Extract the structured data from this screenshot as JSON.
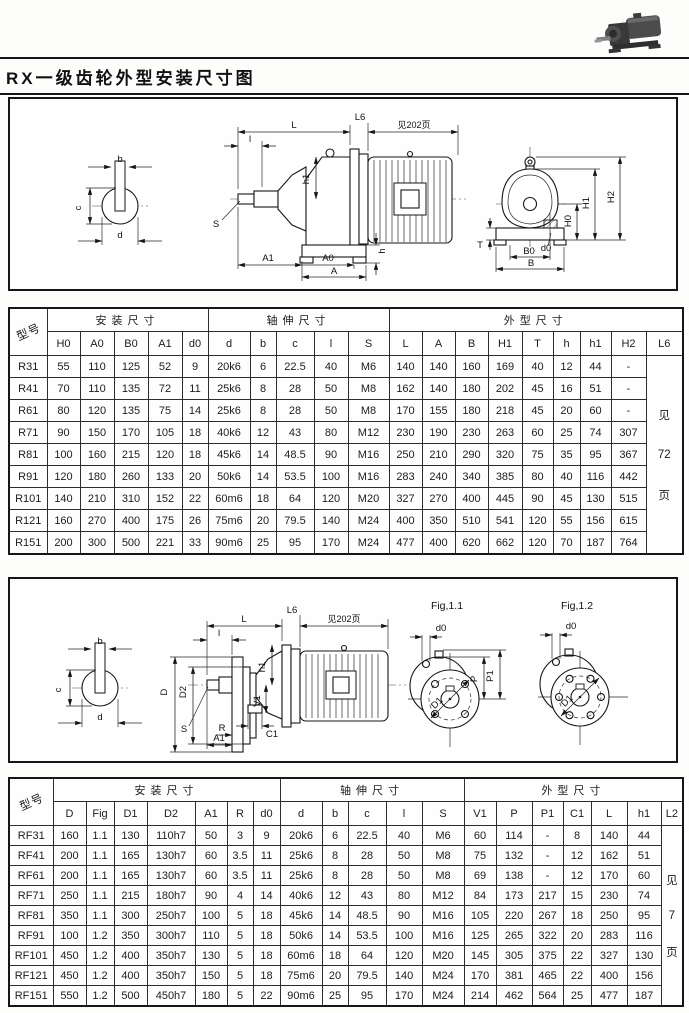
{
  "page": {
    "title": "RX一级齿轮外型安装尺寸图"
  },
  "diagram1": {
    "section": {
      "b": "b",
      "c": "c",
      "d": "d"
    },
    "side": {
      "L": "L",
      "L6": "L6",
      "see_note": "见202页",
      "l": "l",
      "h1": "h1",
      "h": "h",
      "A1": "A1",
      "A0": "A0",
      "A": "A",
      "S": "S"
    },
    "front": {
      "H0": "H0",
      "H1": "H1",
      "H2": "H2",
      "d0": "d0",
      "T": "T",
      "B0": "B0",
      "B": "B"
    }
  },
  "table1": {
    "model_header": "型号",
    "groups": {
      "install": "安装尺寸",
      "shaft": "轴伸尺寸",
      "outline": "外型尺寸"
    },
    "columns": [
      "H0",
      "A0",
      "B0",
      "A1",
      "d0",
      "d",
      "b",
      "c",
      "l",
      "S",
      "L",
      "A",
      "B",
      "H1",
      "T",
      "h",
      "h1",
      "H2",
      "L6"
    ],
    "note_lines": [
      "见",
      "72",
      "页"
    ],
    "rows": [
      {
        "model": "R31",
        "values": [
          "55",
          "110",
          "125",
          "52",
          "9",
          "20k6",
          "6",
          "22.5",
          "40",
          "M6",
          "140",
          "140",
          "160",
          "169",
          "40",
          "12",
          "44",
          "-"
        ]
      },
      {
        "model": "R41",
        "values": [
          "70",
          "110",
          "135",
          "72",
          "11",
          "25k6",
          "8",
          "28",
          "50",
          "M8",
          "162",
          "140",
          "180",
          "202",
          "45",
          "16",
          "51",
          "-"
        ]
      },
      {
        "model": "R61",
        "values": [
          "80",
          "120",
          "135",
          "75",
          "14",
          "25k6",
          "8",
          "28",
          "50",
          "M8",
          "170",
          "155",
          "180",
          "218",
          "45",
          "20",
          "60",
          "-"
        ]
      },
      {
        "model": "R71",
        "values": [
          "90",
          "150",
          "170",
          "105",
          "18",
          "40k6",
          "12",
          "43",
          "80",
          "M12",
          "230",
          "190",
          "230",
          "263",
          "60",
          "25",
          "74",
          "307"
        ]
      },
      {
        "model": "R81",
        "values": [
          "100",
          "160",
          "215",
          "120",
          "18",
          "45k6",
          "14",
          "48.5",
          "90",
          "M16",
          "250",
          "210",
          "290",
          "320",
          "75",
          "35",
          "95",
          "367"
        ]
      },
      {
        "model": "R91",
        "values": [
          "120",
          "180",
          "260",
          "133",
          "20",
          "50k6",
          "14",
          "53.5",
          "100",
          "M16",
          "283",
          "240",
          "340",
          "385",
          "80",
          "40",
          "116",
          "442"
        ]
      },
      {
        "model": "R101",
        "values": [
          "140",
          "210",
          "310",
          "152",
          "22",
          "60m6",
          "18",
          "64",
          "120",
          "M20",
          "327",
          "270",
          "400",
          "445",
          "90",
          "45",
          "130",
          "515"
        ]
      },
      {
        "model": "R121",
        "values": [
          "160",
          "270",
          "400",
          "175",
          "26",
          "75m6",
          "20",
          "79.5",
          "140",
          "M24",
          "400",
          "350",
          "510",
          "541",
          "120",
          "55",
          "156",
          "615"
        ]
      },
      {
        "model": "R151",
        "values": [
          "200",
          "300",
          "500",
          "221",
          "33",
          "90m6",
          "25",
          "95",
          "170",
          "M24",
          "477",
          "400",
          "620",
          "662",
          "120",
          "70",
          "187",
          "764"
        ]
      }
    ]
  },
  "diagram2": {
    "section": {
      "b": "b",
      "c": "c",
      "d": "d"
    },
    "side": {
      "L": "L",
      "L6": "L6",
      "see_note": "见202页",
      "l": "l",
      "D": "D",
      "D2": "D2",
      "h1": "h1",
      "V1": "V1",
      "C1": "C1",
      "R": "R",
      "A1": "A1",
      "S": "S"
    },
    "fig11": {
      "title": "Fig,1.1",
      "d0": "d0",
      "P": "P",
      "P1": "P1",
      "D1": "D1"
    },
    "fig12": {
      "title": "Fig,1.2",
      "d0": "d0",
      "D1": "D1"
    }
  },
  "table2": {
    "model_header": "型号",
    "groups": {
      "install": "安装尺寸",
      "shaft": "轴伸尺寸",
      "outline": "外型尺寸"
    },
    "columns": [
      "D",
      "Fig",
      "D1",
      "D2",
      "A1",
      "R",
      "d0",
      "d",
      "b",
      "c",
      "l",
      "S",
      "V1",
      "P",
      "P1",
      "C1",
      "L",
      "h1",
      "L2"
    ],
    "note_lines": [
      "见",
      "7",
      "页"
    ],
    "rows": [
      {
        "model": "RF31",
        "values": [
          "160",
          "1.1",
          "130",
          "110h7",
          "50",
          "3",
          "9",
          "20k6",
          "6",
          "22.5",
          "40",
          "M6",
          "60",
          "114",
          "-",
          "8",
          "140",
          "44"
        ]
      },
      {
        "model": "RF41",
        "values": [
          "200",
          "1.1",
          "165",
          "130h7",
          "60",
          "3.5",
          "11",
          "25k6",
          "8",
          "28",
          "50",
          "M8",
          "75",
          "132",
          "-",
          "12",
          "162",
          "51"
        ]
      },
      {
        "model": "RF61",
        "values": [
          "200",
          "1.1",
          "165",
          "130h7",
          "60",
          "3.5",
          "11",
          "25k6",
          "8",
          "28",
          "50",
          "M8",
          "69",
          "138",
          "-",
          "12",
          "170",
          "60"
        ]
      },
      {
        "model": "RF71",
        "values": [
          "250",
          "1.1",
          "215",
          "180h7",
          "90",
          "4",
          "14",
          "40k6",
          "12",
          "43",
          "80",
          "M12",
          "84",
          "173",
          "217",
          "15",
          "230",
          "74"
        ]
      },
      {
        "model": "RF81",
        "values": [
          "350",
          "1.1",
          "300",
          "250h7",
          "100",
          "5",
          "18",
          "45k6",
          "14",
          "48.5",
          "90",
          "M16",
          "105",
          "220",
          "267",
          "18",
          "250",
          "95"
        ]
      },
      {
        "model": "RF91",
        "values": [
          "100",
          "1.2",
          "350",
          "300h7",
          "110",
          "5",
          "18",
          "50k6",
          "14",
          "53.5",
          "100",
          "M16",
          "125",
          "265",
          "322",
          "20",
          "283",
          "116"
        ]
      },
      {
        "model": "RF101",
        "values": [
          "450",
          "1.2",
          "400",
          "350h7",
          "130",
          "5",
          "18",
          "60m6",
          "18",
          "64",
          "120",
          "M20",
          "145",
          "305",
          "375",
          "22",
          "327",
          "130"
        ]
      },
      {
        "model": "RF121",
        "values": [
          "450",
          "1.2",
          "400",
          "350h7",
          "150",
          "5",
          "18",
          "75m6",
          "20",
          "79.5",
          "140",
          "M24",
          "170",
          "381",
          "465",
          "22",
          "400",
          "156"
        ]
      },
      {
        "model": "RF151",
        "values": [
          "550",
          "1.2",
          "500",
          "450h7",
          "180",
          "5",
          "22",
          "90m6",
          "25",
          "95",
          "170",
          "M24",
          "214",
          "462",
          "564",
          "25",
          "477",
          "187"
        ]
      }
    ]
  }
}
